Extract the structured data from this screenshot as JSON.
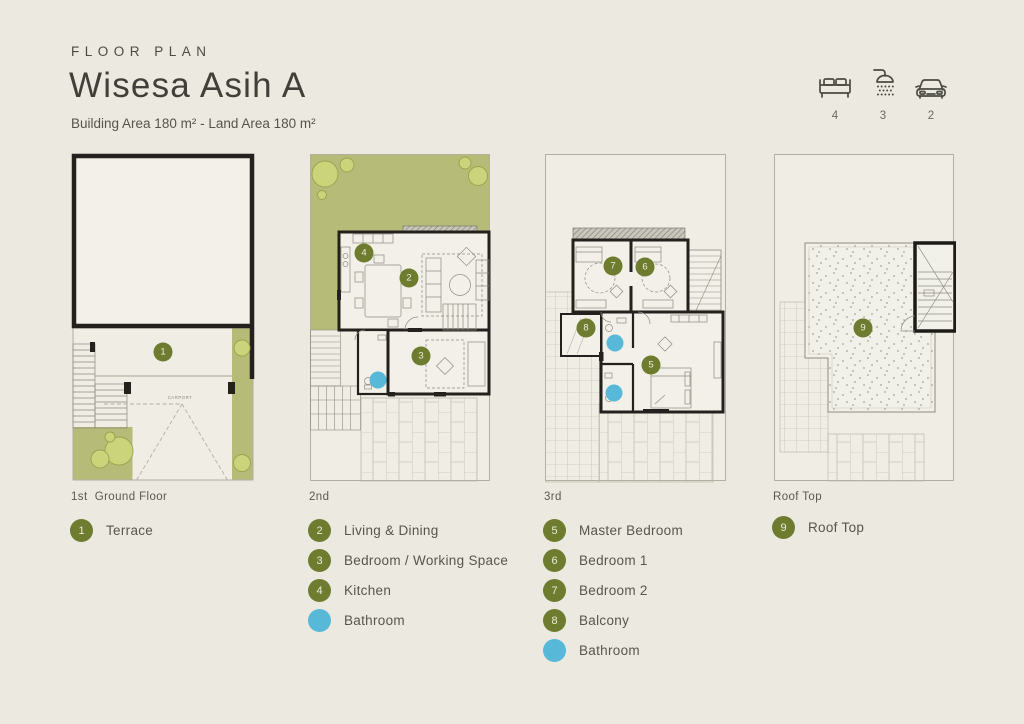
{
  "header": {
    "eyebrow": "FLOOR PLAN",
    "title": "Wisesa Asih A",
    "subtitle": "Building Area 180 m² - Land Area 180 m²"
  },
  "amenities": [
    {
      "icon": "bed-icon",
      "count": "4"
    },
    {
      "icon": "shower-icon",
      "count": "3"
    },
    {
      "icon": "car-icon",
      "count": "2"
    }
  ],
  "floors": {
    "ground": {
      "label": "1st  Ground Floor",
      "carport_label": "CARPORT",
      "markers": [
        "1"
      ],
      "legend": [
        {
          "num": "1",
          "color": "green",
          "label": "Terrace"
        }
      ]
    },
    "second": {
      "label": "2nd",
      "markers": [
        "4",
        "2",
        "3"
      ],
      "legend": [
        {
          "num": "2",
          "color": "green",
          "label": "Living & Dining"
        },
        {
          "num": "3",
          "color": "green",
          "label": "Bedroom / Working Space"
        },
        {
          "num": "4",
          "color": "green",
          "label": "Kitchen"
        },
        {
          "num": "",
          "color": "blue",
          "label": "Bathroom"
        }
      ]
    },
    "third": {
      "label": "3rd",
      "markers": [
        "7",
        "6",
        "8",
        "5"
      ],
      "legend": [
        {
          "num": "5",
          "color": "green",
          "label": "Master Bedroom"
        },
        {
          "num": "6",
          "color": "green",
          "label": "Bedroom 1"
        },
        {
          "num": "7",
          "color": "green",
          "label": "Bedroom 2"
        },
        {
          "num": "8",
          "color": "green",
          "label": "Balcony"
        },
        {
          "num": "",
          "color": "blue",
          "label": "Bathroom"
        }
      ]
    },
    "roof": {
      "label": "Roof Top",
      "markers": [
        "9"
      ],
      "legend": [
        {
          "num": "9",
          "color": "green",
          "label": "Roof Top"
        }
      ]
    }
  },
  "colors": {
    "background": "#ECE9E0",
    "marker_green": "#6D7C2E",
    "marker_blue": "#58B8D8",
    "garden_green": "#B6BB78",
    "tree_green": "#CBD37B",
    "wall": "#23211D",
    "text": "#55544B"
  }
}
